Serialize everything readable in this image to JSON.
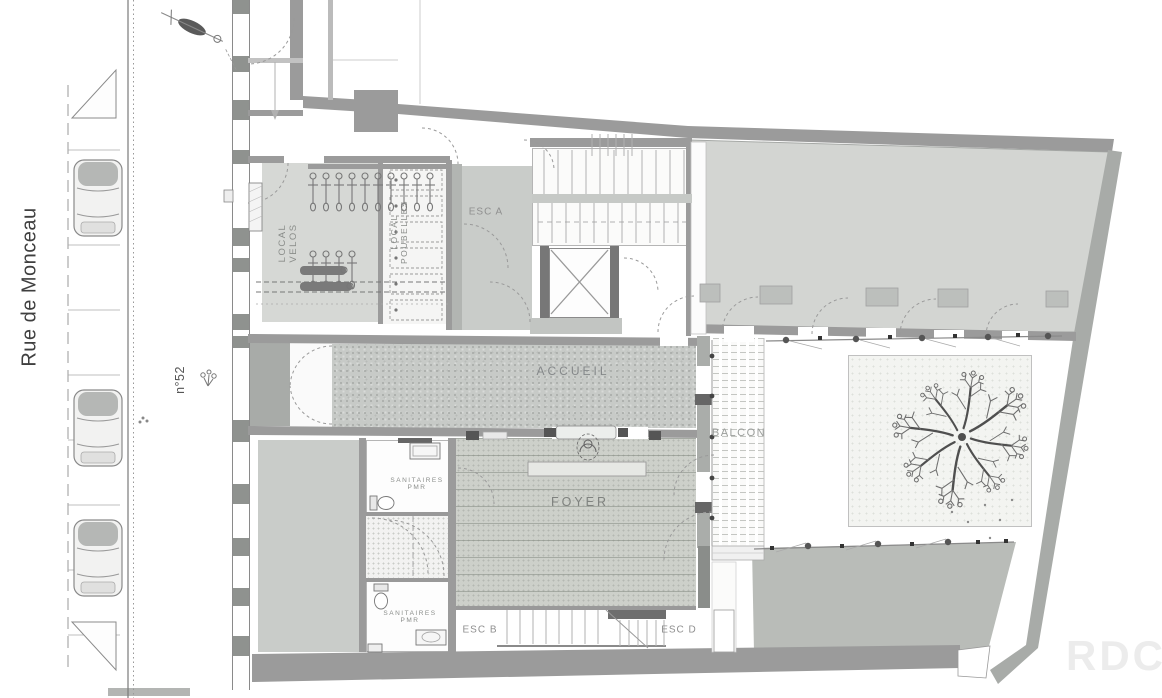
{
  "floor": {
    "watermark": "RDC"
  },
  "street": {
    "name": "Rue de Monceau",
    "building_number": "n°52"
  },
  "rooms": {
    "local_velos": {
      "line1": "LOCAL",
      "line2": "VELOS"
    },
    "local_poubelles": {
      "line1": "LOCAL",
      "line2": "POUBELLES"
    },
    "esc_a": {
      "label": "ESC A"
    },
    "esc_b": {
      "label": "ESC B"
    },
    "esc_d": {
      "label": "ESC D"
    },
    "accueil": {
      "label": "ACCUEIL"
    },
    "balcon": {
      "label": "BALCON"
    },
    "foyer": {
      "label": "FOYER"
    },
    "sanitaires_pmr_upper": {
      "line1": "SANITAIRES",
      "line2": "PMR"
    },
    "sanitaires_pmr_lower": {
      "line1": "SANITAIRES",
      "line2": "PMR"
    }
  },
  "palette": {
    "wall": "#9b9b9b",
    "wall_dark": "#777777",
    "floor_hall": "#d3d5d2",
    "floor_room": "#c9ccc9",
    "carpet": "#c7cac7",
    "walkway": "#b9bcb8",
    "line": "#8a8a8a",
    "label_text": "#8a8d8a",
    "watermark": "#ededed"
  },
  "symbols": {
    "tree": "tree-icon",
    "car": "car-icon",
    "scooter": "scooter-icon",
    "bicycle": "bike-icon",
    "toilet": "toilet-icon",
    "person": "person-icon",
    "elevator_cross": "elevator-cross-icon",
    "door_swing": "door-arc-icon"
  }
}
